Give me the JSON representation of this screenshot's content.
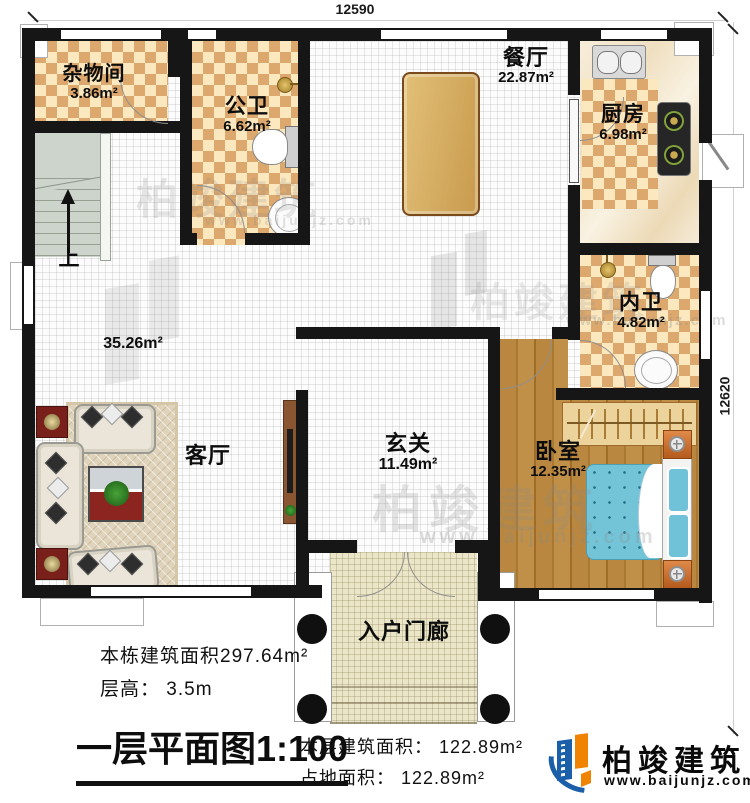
{
  "dimensions": {
    "top": "12590",
    "right": "12620"
  },
  "rooms": {
    "storage": {
      "name": "杂物间",
      "area": "3.86m²"
    },
    "public_bath": {
      "name": "公卫",
      "area": "6.62m²"
    },
    "dining": {
      "name": "餐厅",
      "area": "22.87m²"
    },
    "kitchen": {
      "name": "厨房",
      "area": "6.98m²"
    },
    "inner_bath": {
      "name": "内卫",
      "area": "4.82m²"
    },
    "bedroom": {
      "name": "卧室",
      "area": "12.35m²"
    },
    "foyer": {
      "name": "玄关",
      "area": "11.49m²"
    },
    "living": {
      "name": "客厅",
      "area": "35.26m²"
    },
    "porch": {
      "name": "入户门廊"
    },
    "stairs": {
      "direction_label": "上"
    }
  },
  "title_block": {
    "building_total_area": "本栋建筑面积297.64m²",
    "floor_height": "层高： 3.5m",
    "plan_title": "一层平面图1:100",
    "floor_area": "本层建筑面积： 122.89m²",
    "footprint_area": "占地面积： 122.89m²"
  },
  "branding": {
    "company": "柏竣建筑",
    "website": "www.baijunjz.com"
  },
  "colors": {
    "wall": "#161616",
    "checker_dark": "#dca86d",
    "checker_light": "#fbe8bf",
    "wood": "#b5823f",
    "bed_blue": "#74c4d8",
    "stair_gray": "#cdd4cb",
    "porch_floor": "#ece6c9",
    "logo_blue": "#1b5fa8",
    "logo_orange": "#f08300"
  }
}
